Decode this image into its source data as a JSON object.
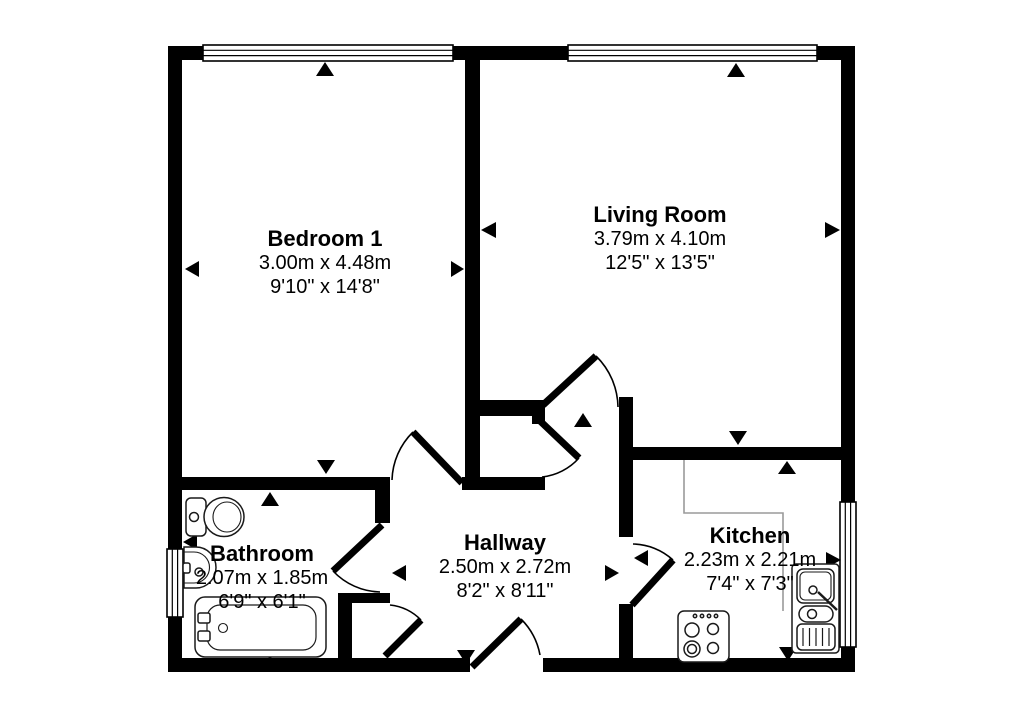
{
  "plan": {
    "background": "#ffffff",
    "wall_color": "#000000",
    "fixture_line_color": "#1a1a1a",
    "counter_line_color": "#9a9a9a",
    "text_color": "#000000"
  },
  "rooms": [
    {
      "name": "Bedroom 1",
      "size_metric": "3.00m x 4.48m",
      "size_imperial": "9'10\" x 14'8\"",
      "markers": [
        "top",
        "bottom",
        "left",
        "right"
      ]
    },
    {
      "name": "Living Room",
      "size_metric": "3.79m x 4.10m",
      "size_imperial": "12'5\" x 13'5\"",
      "markers": [
        "top",
        "bottom",
        "left",
        "right"
      ]
    },
    {
      "name": "Bathroom",
      "size_metric": "2.07m x 1.85m",
      "size_imperial": "6'9\" x 6'1\"",
      "markers": [
        "top",
        "bottom",
        "left"
      ]
    },
    {
      "name": "Hallway",
      "size_metric": "2.50m x 2.72m",
      "size_imperial": "8'2\" x 8'11\"",
      "markers": [
        "top",
        "bottom",
        "left",
        "right"
      ]
    },
    {
      "name": "Kitchen",
      "size_metric": "2.23m x 2.21m",
      "size_imperial": "7'4\" x 7'3\"",
      "markers": [
        "top",
        "bottom",
        "left",
        "right"
      ]
    }
  ],
  "fixtures": [
    {
      "id": "toilet",
      "room": "Bathroom"
    },
    {
      "id": "wash-basin",
      "room": "Bathroom"
    },
    {
      "id": "bathtub",
      "room": "Bathroom"
    },
    {
      "id": "worktop",
      "room": "Kitchen"
    },
    {
      "id": "cooker-hob",
      "room": "Kitchen"
    },
    {
      "id": "sink-drainer-unit",
      "room": "Kitchen"
    },
    {
      "id": "storage-cupboard",
      "room": "Hallway"
    },
    {
      "id": "storage-cupboard",
      "room": "Hallway"
    }
  ],
  "openings": {
    "windows": 4,
    "doors": 7
  }
}
